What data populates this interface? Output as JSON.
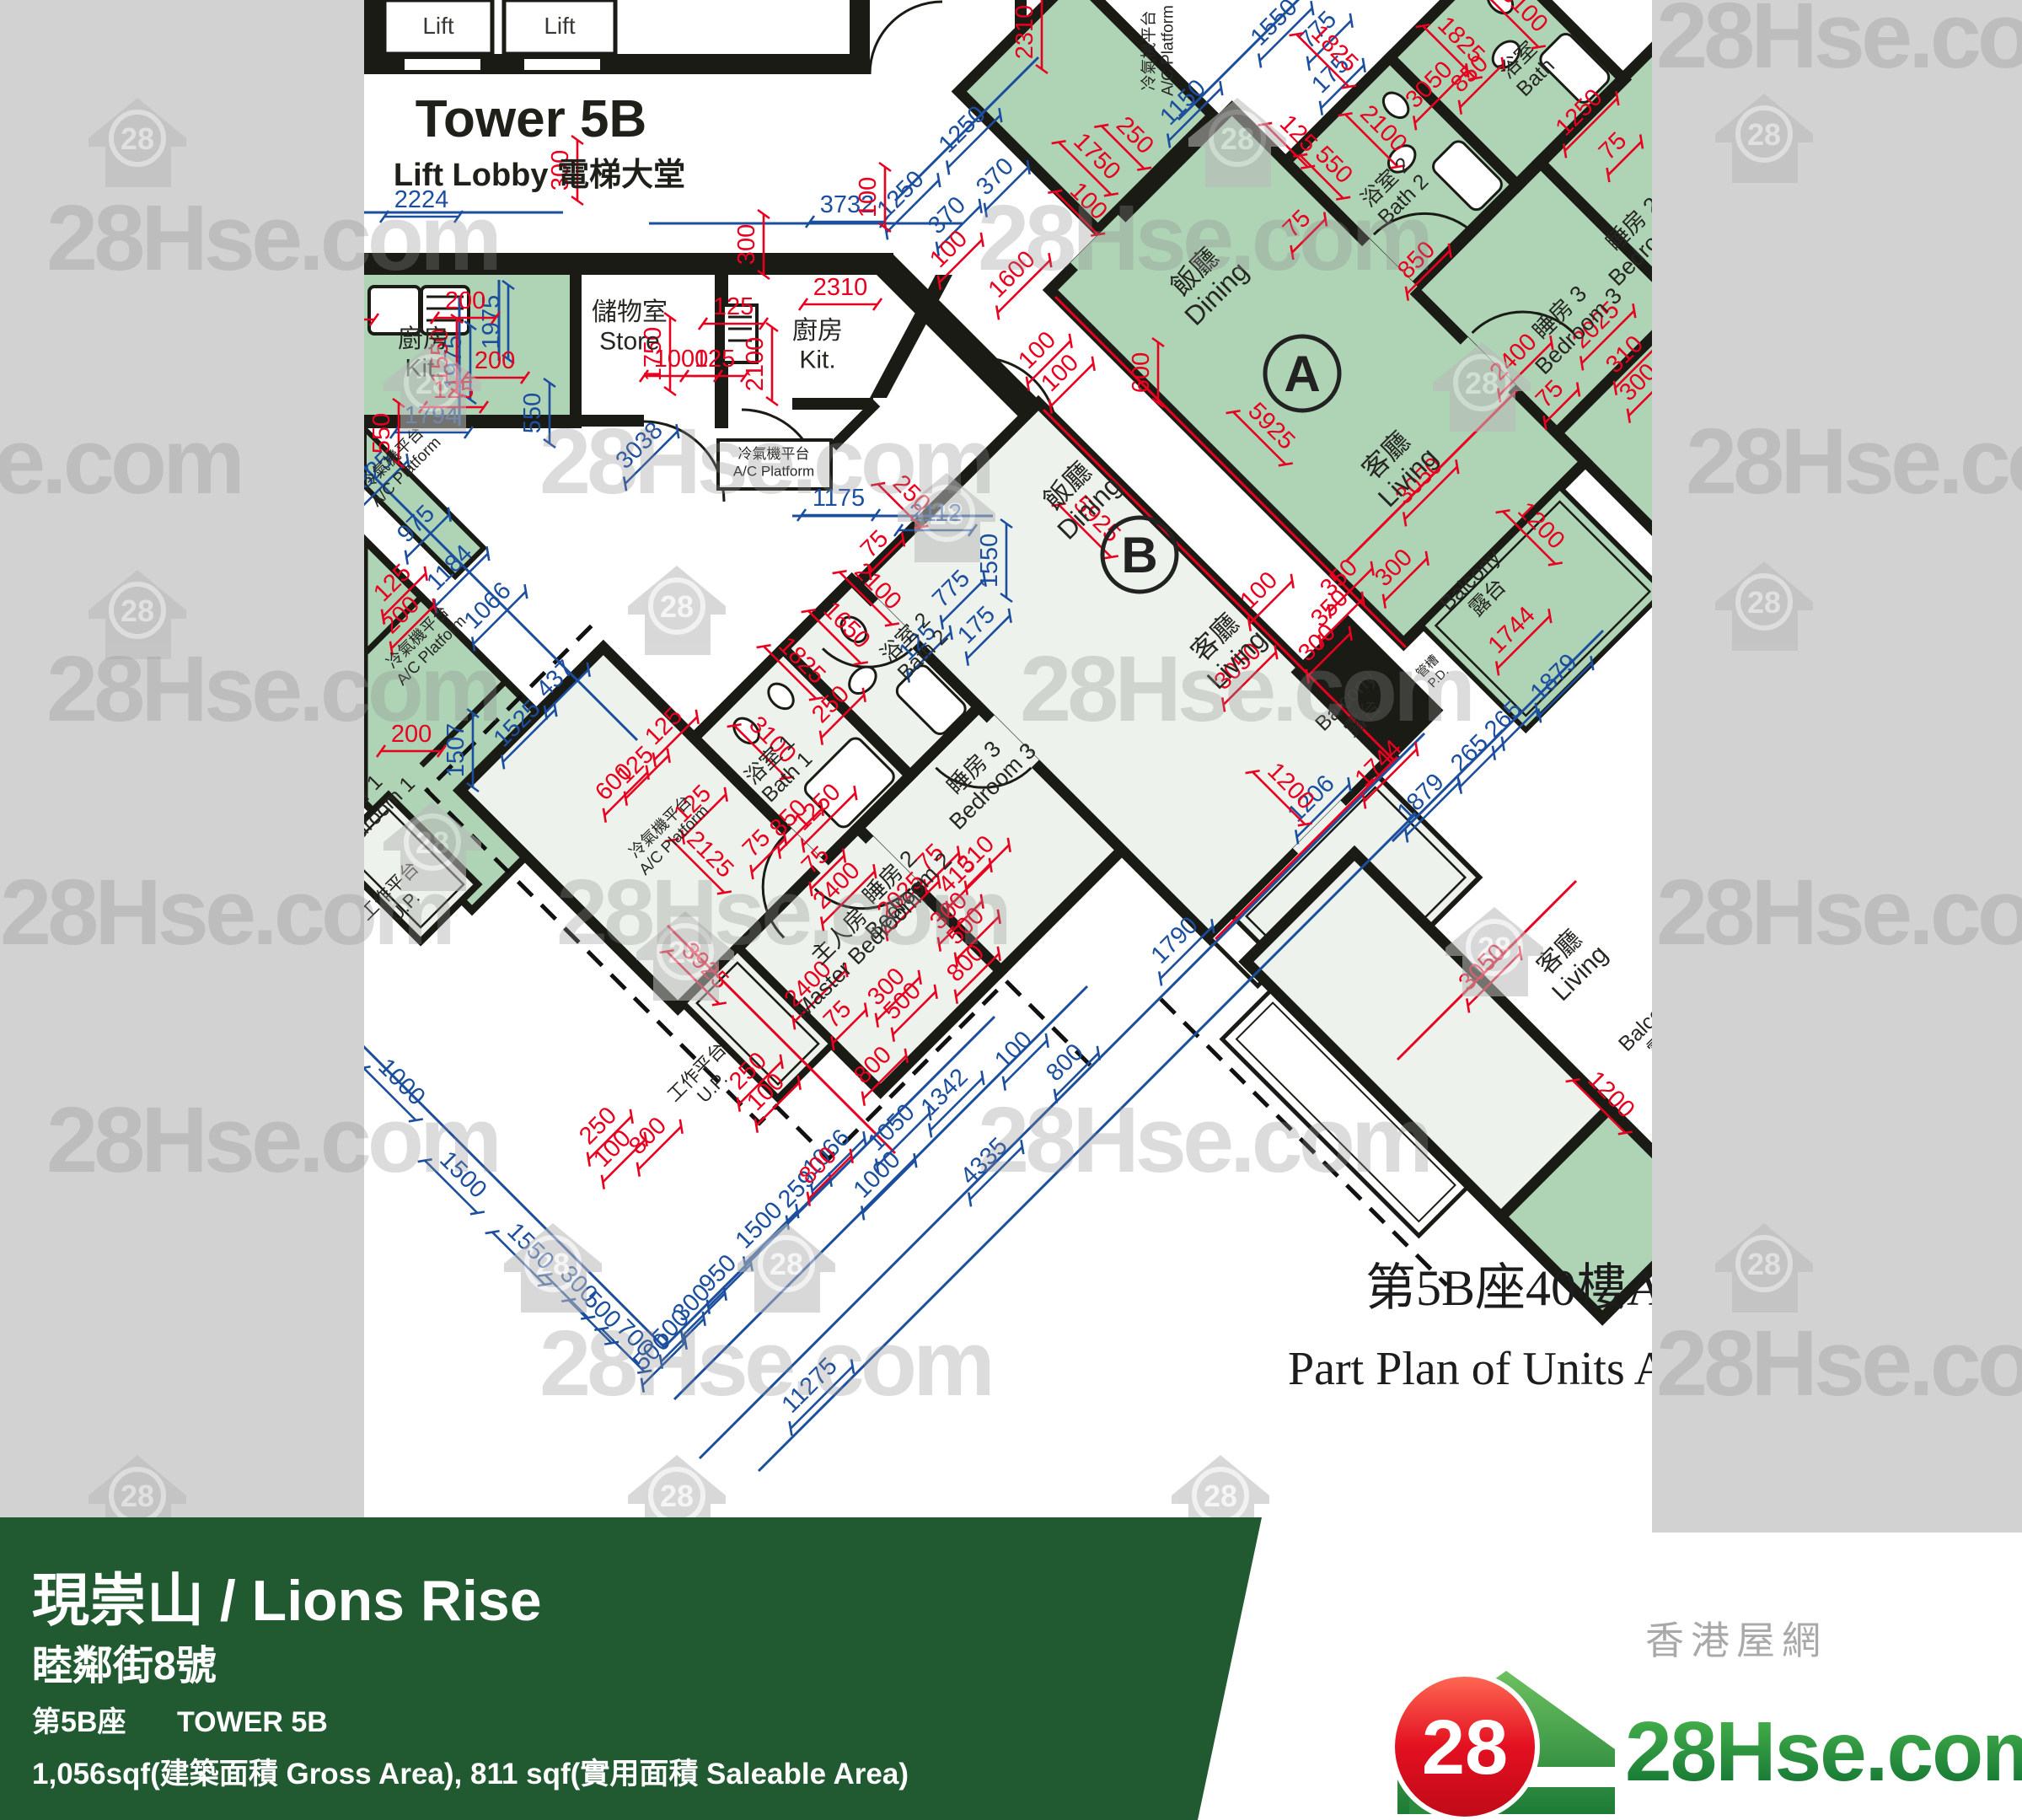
{
  "colors": {
    "margin_gray": "#d2d2d2",
    "paper": "#ffffff",
    "unit_green": "#aed3b5",
    "unit_light": "#edf3ec",
    "wall": "#1b1b15",
    "dim_red": "#e8001f",
    "dim_blue": "#1c4e9e",
    "banner_green": "#215931",
    "logo_red": "#dd1111",
    "logo_green_dark": "#0e6e31",
    "logo_green_light": "#4cb94e"
  },
  "watermark": {
    "text": "28Hse.com",
    "badge": "28",
    "houses": [
      [
        105,
        100
      ],
      [
        1410,
        100
      ],
      [
        2035,
        95
      ],
      [
        455,
        390
      ],
      [
        1065,
        545
      ],
      [
        1700,
        390
      ],
      [
        105,
        660
      ],
      [
        745,
        655
      ],
      [
        2035,
        650
      ],
      [
        455,
        935
      ],
      [
        755,
        1065
      ],
      [
        1715,
        1060
      ],
      [
        598,
        1435
      ],
      [
        875,
        1435
      ],
      [
        2035,
        1435
      ],
      [
        105,
        1710
      ],
      [
        745,
        1710
      ],
      [
        1390,
        1710
      ]
    ],
    "texts": [
      [
        55,
        320
      ],
      [
        1160,
        320
      ],
      [
        1965,
        80
      ],
      [
        -250,
        585
      ],
      [
        640,
        585
      ],
      [
        2000,
        585
      ],
      [
        55,
        855
      ],
      [
        1210,
        855
      ],
      [
        0,
        1120
      ],
      [
        660,
        1120
      ],
      [
        1965,
        1120
      ],
      [
        55,
        1390
      ],
      [
        1160,
        1390
      ],
      [
        640,
        1655
      ],
      [
        1965,
        1655
      ]
    ]
  },
  "plan": {
    "title": "Tower 5B",
    "subtitle": "Lift Lobby 電梯大堂",
    "caption_zh": "第5B座40樓A",
    "caption_en": "Part Plan of Units A",
    "lift_label": "Lift",
    "lifts": [
      [
        520,
        40
      ],
      [
        664,
        40
      ]
    ],
    "units": [
      [
        "A",
        1545,
        443
      ],
      [
        "B",
        1352,
        658
      ]
    ],
    "rooms": [
      [
        "廚房",
        "Kit.",
        502,
        412,
        0,
        30
      ],
      [
        "儲物室",
        "Store",
        747,
        380,
        0,
        30
      ],
      [
        "廚房",
        "Kit.",
        970,
        402,
        0,
        30
      ],
      [
        "冷氣機平台",
        "A/C Platform",
        918,
        544,
        0,
        17
      ],
      [
        "冷氣機平台",
        "A/C Platform",
        470,
        548,
        -45,
        19
      ],
      [
        "冷氣機平台",
        "A/C Platform",
        500,
        760,
        -45,
        19
      ],
      [
        "冷氣機平台",
        "A/C Platform",
        788,
        985,
        -45,
        19
      ],
      [
        "冷氣機平台",
        "A/C Platform",
        1369,
        60,
        -90,
        19
      ],
      [
        "飯廳",
        "Dining",
        1425,
        330,
        -45,
        32
      ],
      [
        "客廳",
        "Living",
        1652,
        548,
        -45,
        32
      ],
      [
        "飯廳",
        "Dining",
        1274,
        584,
        -45,
        32
      ],
      [
        "客廳",
        "Living",
        1449,
        764,
        -45,
        32
      ],
      [
        "浴室 2",
        "Bath 2",
        1080,
        762,
        -45,
        25
      ],
      [
        "浴室 1",
        "Bath 1",
        919,
        907,
        -45,
        25
      ],
      [
        "睡房 3",
        "Bedroom 3",
        1162,
        917,
        -45,
        27
      ],
      [
        "睡房 2",
        "Bedroom 2",
        1062,
        1047,
        -45,
        27
      ],
      [
        "主人房",
        "Master Bedroom",
        1002,
        1117,
        -45,
        27
      ],
      [
        "工作平台",
        "U.P.",
        832,
        1277,
        -45,
        22
      ],
      [
        "工作平台",
        "U.P.",
        467,
        1062,
        -45,
        22
      ],
      [
        "浴室 2",
        "Bath 2",
        1650,
        222,
        -45,
        25
      ],
      [
        "浴室",
        "Bath",
        1807,
        77,
        -45,
        25
      ],
      [
        "睡房 3",
        "Bedroom 3",
        1857,
        377,
        -45,
        27
      ],
      [
        "睡房 2",
        "Bedroom 2",
        1944,
        272,
        -45,
        27
      ],
      [
        "Balcony",
        "露台",
        1750,
        694,
        -45,
        25
      ],
      [
        "Balcony",
        "露台",
        1602,
        837,
        -45,
        25
      ],
      [
        "管槽",
        "P.D.",
        1697,
        794,
        -45,
        15
      ],
      [
        "客廳",
        "Living",
        1857,
        1137,
        -45,
        30
      ],
      [
        "Balcony",
        "露台",
        1962,
        1217,
        -45,
        25
      ],
      [
        "睡房 1",
        "Bedroom 1",
        430,
        954,
        -45,
        25
      ]
    ],
    "dims": [
      [
        2224,
        "b",
        500,
        246,
        0
      ],
      [
        3732,
        "b",
        1005,
        252,
        0
      ],
      [
        1975,
        "b",
        547,
        430,
        -90
      ],
      [
        1975,
        "b",
        592,
        382,
        -90
      ],
      [
        550,
        "b",
        641,
        490,
        -90
      ],
      [
        1794,
        "b",
        512,
        502,
        0
      ],
      [
        1250,
        "b",
        1148,
        160,
        -45
      ],
      [
        370,
        "b",
        1187,
        216,
        -45
      ],
      [
        1250,
        "b",
        1075,
        237,
        -45
      ],
      [
        370,
        "b",
        1130,
        262,
        -45
      ],
      [
        1550,
        "b",
        1518,
        33,
        -45
      ],
      [
        775,
        "b",
        1570,
        42,
        -45
      ],
      [
        175,
        "b",
        1585,
        95,
        -45
      ],
      [
        1150,
        "b",
        1410,
        128,
        -45
      ],
      [
        1175,
        "b",
        995,
        600,
        0
      ],
      [
        2112,
        "b",
        1110,
        618,
        0
      ],
      [
        1550,
        "b",
        1183,
        665,
        -90
      ],
      [
        775,
        "b",
        1135,
        705,
        -45
      ],
      [
        175,
        "b",
        1165,
        748,
        -45
      ],
      [
        125,
        "b",
        1095,
        768,
        -45
      ],
      [
        3038,
        "b",
        765,
        535,
        -45
      ],
      [
        1325,
        "b",
        445,
        570,
        -45
      ],
      [
        975,
        "b",
        500,
        628,
        -45
      ],
      [
        1184,
        "b",
        540,
        680,
        -45
      ],
      [
        1066,
        "b",
        585,
        725,
        -45
      ],
      [
        437,
        "b",
        665,
        812,
        -45
      ],
      [
        1525,
        "b",
        620,
        865,
        -45
      ],
      [
        1507,
        "b",
        550,
        890,
        -90
      ],
      [
        1000,
        "b",
        470,
        1290,
        45
      ],
      [
        1500,
        "b",
        543,
        1400,
        45
      ],
      [
        1550,
        "b",
        623,
        1485,
        45
      ],
      [
        300,
        "b",
        680,
        1530,
        45
      ],
      [
        500,
        "b",
        708,
        1560,
        45
      ],
      [
        700,
        "b",
        747,
        1594,
        45
      ],
      [
        500,
        "b",
        780,
        1610,
        -45
      ],
      [
        500,
        "b",
        802,
        1582,
        -45
      ],
      [
        300,
        "b",
        827,
        1552,
        -45
      ],
      [
        950,
        "b",
        858,
        1517,
        -45
      ],
      [
        1500,
        "b",
        907,
        1460,
        -45
      ],
      [
        259,
        "b",
        952,
        1417,
        -45
      ],
      [
        1066,
        "b",
        987,
        1374,
        -45
      ],
      [
        1000,
        "b",
        1047,
        1400,
        -45
      ],
      [
        1050,
        "b",
        1064,
        1344,
        -45
      ],
      [
        1342,
        "b",
        1127,
        1302,
        -45
      ],
      [
        4335,
        "b",
        1174,
        1384,
        -45
      ],
      [
        11275,
        "b",
        967,
        1650,
        -45
      ],
      [
        100,
        "b",
        1209,
        1252,
        -45
      ],
      [
        800,
        "b",
        1270,
        1267,
        -45
      ],
      [
        1790,
        "b",
        1400,
        1122,
        -45
      ],
      [
        1206,
        "b",
        1562,
        954,
        -45
      ],
      [
        1879,
        "b",
        1692,
        952,
        -45
      ],
      [
        265,
        "b",
        1750,
        900,
        -45
      ],
      [
        265,
        "b",
        1790,
        860,
        -45
      ],
      [
        1879,
        "b",
        1850,
        810,
        -45
      ],
      [
        1970,
        "r",
        400,
        368,
        0
      ],
      [
        300,
        "r",
        674,
        202,
        -90
      ],
      [
        300,
        "r",
        895,
        290,
        -90
      ],
      [
        100,
        "r",
        1039,
        234,
        -90
      ],
      [
        200,
        "r",
        552,
        366,
        0
      ],
      [
        200,
        "r",
        587,
        437,
        0
      ],
      [
        1550,
        "r",
        531,
        422,
        -90
      ],
      [
        125,
        "r",
        538,
        472,
        0
      ],
      [
        550,
        "r",
        462,
        514,
        -90
      ],
      [
        1750,
        "r",
        784,
        420,
        -90
      ],
      [
        1000,
        "r",
        808,
        435,
        0
      ],
      [
        125,
        "r",
        848,
        435,
        0
      ],
      [
        2100,
        "r",
        905,
        432,
        -90
      ],
      [
        2310,
        "r",
        997,
        350,
        0
      ],
      [
        125,
        "r",
        870,
        373,
        0
      ],
      [
        2310,
        "r",
        1225,
        38,
        -90
      ],
      [
        600,
        "r",
        1363,
        442,
        -90
      ],
      [
        1750,
        "r",
        1295,
        192,
        45
      ],
      [
        100,
        "r",
        1285,
        245,
        45
      ],
      [
        250,
        "r",
        1340,
        167,
        45
      ],
      [
        1600,
        "r",
        1207,
        332,
        -45
      ],
      [
        100,
        "r",
        1132,
        302,
        -45
      ],
      [
        100,
        "r",
        1237,
        422,
        -45
      ],
      [
        100,
        "r",
        1264,
        449,
        -45
      ],
      [
        5925,
        "r",
        1502,
        512,
        45
      ],
      [
        5925,
        "r",
        1295,
        622,
        45
      ],
      [
        3050,
        "r",
        1702,
        107,
        -45
      ],
      [
        850,
        "r",
        1750,
        94,
        -45
      ],
      [
        1825,
        "r",
        1727,
        54,
        45
      ],
      [
        1825,
        "r",
        1577,
        64,
        45
      ],
      [
        2100,
        "r",
        1635,
        159,
        45
      ],
      [
        550,
        "r",
        1576,
        202,
        45
      ],
      [
        125,
        "r",
        1534,
        165,
        45
      ],
      [
        75,
        "r",
        1545,
        272,
        -45
      ],
      [
        850,
        "r",
        1687,
        315,
        -45
      ],
      [
        1250,
        "r",
        1880,
        140,
        -45
      ],
      [
        75,
        "r",
        1920,
        180,
        -45
      ],
      [
        2400,
        "r",
        1802,
        430,
        -45
      ],
      [
        75,
        "r",
        1845,
        474,
        -45
      ],
      [
        2025,
        "r",
        1900,
        392,
        -45
      ],
      [
        310,
        "r",
        1934,
        427,
        -45
      ],
      [
        300,
        "r",
        1950,
        460,
        -45
      ],
      [
        3100,
        "r",
        1802,
        17,
        45
      ],
      [
        250,
        "r",
        1075,
        592,
        45
      ],
      [
        75,
        "r",
        1044,
        652,
        -45
      ],
      [
        2100,
        "r",
        1035,
        702,
        45
      ],
      [
        1650,
        "r",
        998,
        748,
        45
      ],
      [
        1825,
        "r",
        945,
        790,
        45
      ],
      [
        250,
        "r",
        992,
        842,
        -45
      ],
      [
        3100,
        "r",
        910,
        884,
        45
      ],
      [
        125,
        "r",
        828,
        960,
        -45
      ],
      [
        850,
        "r",
        942,
        977,
        -45
      ],
      [
        75,
        "r",
        904,
        1007,
        -45
      ],
      [
        1250,
        "r",
        976,
        964,
        -45
      ],
      [
        2400,
        "r",
        999,
        1057,
        -45
      ],
      [
        75,
        "r",
        974,
        1027,
        -45
      ],
      [
        2025,
        "r",
        1075,
        1069,
        -45
      ],
      [
        75,
        "r",
        1110,
        1024,
        -45
      ],
      [
        415,
        "r",
        1142,
        1044,
        -45
      ],
      [
        310,
        "r",
        1164,
        1020,
        -45
      ],
      [
        300,
        "r",
        1132,
        1087,
        -45
      ],
      [
        500,
        "r",
        1152,
        1105,
        -45
      ],
      [
        800,
        "r",
        1152,
        1149,
        -45
      ],
      [
        300,
        "r",
        1058,
        1177,
        -45
      ],
      [
        500,
        "r",
        1077,
        1194,
        -45
      ],
      [
        800,
        "r",
        1042,
        1270,
        -45
      ],
      [
        2125,
        "r",
        836,
        1020,
        45
      ],
      [
        3925,
        "r",
        830,
        1152,
        45
      ],
      [
        2400,
        "r",
        965,
        1174,
        -45
      ],
      [
        75,
        "r",
        1000,
        1210,
        -45
      ],
      [
        250,
        "r",
        894,
        1277,
        -45
      ],
      [
        100,
        "r",
        915,
        1302,
        -45
      ],
      [
        800,
        "r",
        977,
        1389,
        -45
      ],
      [
        250,
        "r",
        716,
        1342,
        -45
      ],
      [
        100,
        "r",
        733,
        1369,
        -45
      ],
      [
        800,
        "r",
        775,
        1354,
        -45
      ],
      [
        100,
        "r",
        1500,
        707,
        -45
      ],
      [
        350,
        "r",
        1595,
        692,
        -45
      ],
      [
        350,
        "r",
        1584,
        728,
        -45
      ],
      [
        300,
        "r",
        1660,
        680,
        -45
      ],
      [
        300,
        "r",
        1569,
        769,
        -45
      ],
      [
        1200,
        "r",
        1822,
        630,
        45
      ],
      [
        1744,
        "r",
        1800,
        754,
        -45
      ],
      [
        1744,
        "r",
        1642,
        912,
        -45
      ],
      [
        1200,
        "r",
        1525,
        939,
        45
      ],
      [
        3050,
        "r",
        1690,
        577,
        -45
      ],
      [
        3050,
        "r",
        1475,
        797,
        -45
      ],
      [
        3050,
        "r",
        1765,
        1154,
        -45
      ],
      [
        1200,
        "r",
        1905,
        1305,
        45
      ],
      [
        125,
        "r",
        472,
        698,
        -45
      ],
      [
        200,
        "r",
        482,
        736,
        -45
      ],
      [
        200,
        "r",
        488,
        880,
        0
      ],
      [
        600,
        "r",
        735,
        934,
        -45
      ],
      [
        125,
        "r",
        760,
        914,
        -45
      ],
      [
        125,
        "r",
        794,
        868,
        -45
      ]
    ]
  },
  "footer": {
    "title": "現崇山 / Lions Rise",
    "address": "睦鄰街8號",
    "tower_zh": "第5B座",
    "tower_en": "TOWER 5B",
    "area": "1,056sqf(建築面積 Gross Area), 811 sqf(實用面積 Saleable Area)"
  },
  "logo": {
    "badge": "28",
    "name": "28Hse.com",
    "tagline": "香港屋網"
  }
}
